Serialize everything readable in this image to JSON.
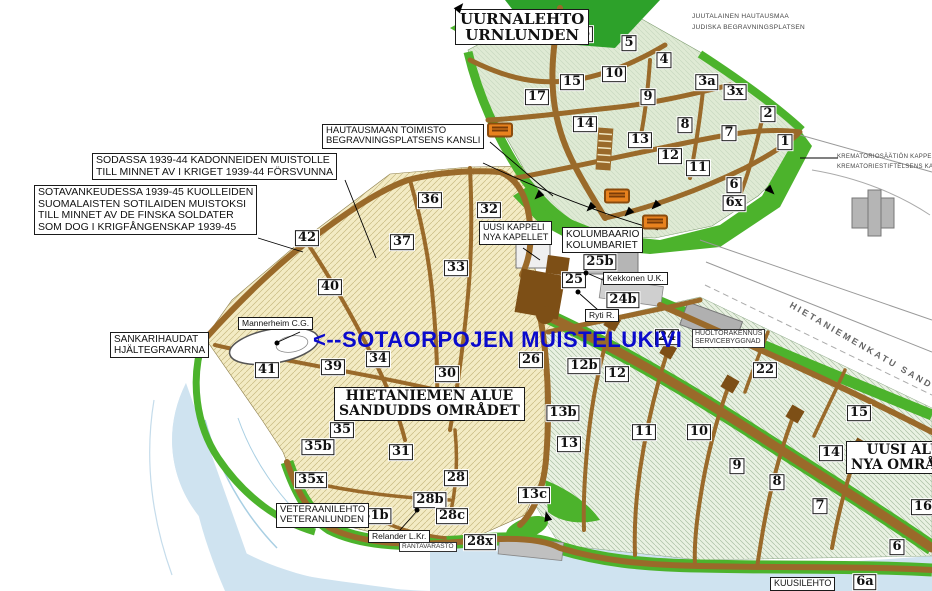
{
  "map": {
    "colors": {
      "water": "#cfe3f0",
      "old_area": "#f3ebc4",
      "new_area": "#e9f1e2",
      "urn_area": "#dfead4",
      "green": "#4cb32c",
      "dark_green": "#2da12a",
      "road": "#9a6a2a",
      "road_dark": "#7d4f16",
      "building": "#b5b5b5",
      "blue_text": "#0a0acc",
      "bus_orange": "#e8821e"
    },
    "labels": [
      {
        "id": "uurnalehto",
        "type": "serif-box",
        "x": 455,
        "y": 9,
        "size": 15,
        "lines": [
          "UURNALEHTO",
          "URNLUNDEN"
        ]
      },
      {
        "id": "juutalainen-hautausmaa",
        "type": "tiny",
        "x": 692,
        "y": 11,
        "size": 6.5,
        "lines": [
          "JUUTALAINEN HAUTAUSMAA",
          "JUDISKA BEGRAVNINGSPLATSEN"
        ]
      },
      {
        "id": "krematorio",
        "type": "tiny",
        "x": 837,
        "y": 152,
        "size": 6,
        "lines": [
          "KREMATORIOSÄÄTIÖN KAPPELI",
          "KREMATORIESTIFTELSENS KAPELL"
        ]
      },
      {
        "id": "hautausmaan-toimisto",
        "type": "box",
        "x": 322,
        "y": 124,
        "size": 9.5,
        "lines": [
          "HAUTAUSMAAN TOIMISTO",
          "BEGRAVNINGSPLATSENS KANSLI"
        ]
      },
      {
        "id": "sodassa-muistolle",
        "type": "box",
        "x": 92,
        "y": 153,
        "size": 10.5,
        "lines": [
          "SODASSA 1939-44 KADONNEIDEN MUISTOLLE",
          "TILL MINNET AV I KRIGET 1939-44 FÖRSVUNNA"
        ]
      },
      {
        "id": "sotavankeudessa",
        "type": "box",
        "x": 34,
        "y": 185,
        "size": 10.5,
        "lines": [
          "SOTAVANKEUDESSA 1939-45 KUOLLEIDEN",
          "SUOMALAISTEN SOTILAIDEN MUISTOKSI",
          "TILL MINNET AV DE FINSKA SOLDATER",
          "SOM DOG I KRIGFÅNGENSKAP 1939-45"
        ]
      },
      {
        "id": "uusi-kappeli",
        "type": "box",
        "x": 479,
        "y": 221,
        "size": 9,
        "lines": [
          "UUSI KAPPELI",
          "NYA KAPELLET"
        ]
      },
      {
        "id": "kolumbaario",
        "type": "box",
        "x": 562,
        "y": 227,
        "size": 10,
        "lines": [
          "KOLUMBAARIO",
          "KOLUMBARIET"
        ]
      },
      {
        "id": "sankarihaudat",
        "type": "box",
        "x": 110,
        "y": 332,
        "size": 10,
        "lines": [
          "SANKARIHAUDAT",
          "HJÄLTEGRAVARNA"
        ]
      },
      {
        "id": "mannerheim",
        "type": "box",
        "x": 238,
        "y": 317,
        "size": 8.5,
        "lines": [
          "Mannerheim C.G."
        ]
      },
      {
        "id": "kekkonen",
        "type": "box",
        "x": 603,
        "y": 272,
        "size": 8.5,
        "lines": [
          "Kekkonen U.K."
        ]
      },
      {
        "id": "ryti",
        "type": "box",
        "x": 585,
        "y": 309,
        "size": 8.5,
        "lines": [
          "Ryti R."
        ]
      },
      {
        "id": "hietaniemen-alue",
        "type": "serif-box",
        "x": 334,
        "y": 387,
        "size": 14,
        "lines": [
          "HIETANIEMEN ALUE",
          "SANDUDDS OMRÅDET"
        ]
      },
      {
        "id": "huoltorakennus",
        "type": "tiny-box",
        "x": 692,
        "y": 329,
        "size": 7,
        "lines": [
          "HUOLTORAKENNUS",
          "SERVICEBYGGNAD"
        ]
      },
      {
        "id": "veteraanilehto",
        "type": "box",
        "x": 276,
        "y": 503,
        "size": 9.5,
        "lines": [
          "VETERAANILEHTO",
          "VETERANLUNDEN"
        ]
      },
      {
        "id": "relander",
        "type": "box",
        "x": 368,
        "y": 530,
        "size": 8.5,
        "lines": [
          "Relander L.Kr."
        ]
      },
      {
        "id": "rantavarasto",
        "type": "tiny-box",
        "x": 399,
        "y": 542,
        "size": 6.5,
        "lines": [
          "RANTAVARASTO"
        ]
      },
      {
        "id": "uusi-alue",
        "type": "serif-box",
        "x": 846,
        "y": 441,
        "size": 13.5,
        "lines": [
          "UUSI ALUE",
          "NYA OMRÅDET"
        ]
      },
      {
        "id": "kuusilehto",
        "type": "box",
        "x": 770,
        "y": 577,
        "size": 9,
        "lines": [
          "KUUSILEHTO"
        ]
      },
      {
        "id": "hietaniemenkatu-street",
        "type": "street",
        "x": 793,
        "y": 300,
        "size": 9,
        "rotate": 30,
        "lines": [
          "HIETANIEMENKATU  SANDUDDSG"
        ]
      },
      {
        "id": "sotaorpojen-muistelukivi",
        "type": "blue",
        "x": 313,
        "y": 327,
        "size": 22,
        "lines": [
          "<--SOTAORPOJEN MUISTELUKIVI"
        ]
      }
    ],
    "plot_numbers": [
      {
        "label": "16",
        "x": 581,
        "y": 34
      },
      {
        "label": "5",
        "x": 629,
        "y": 43
      },
      {
        "label": "4",
        "x": 664,
        "y": 60
      },
      {
        "label": "10",
        "x": 614,
        "y": 74
      },
      {
        "label": "15",
        "x": 572,
        "y": 82
      },
      {
        "label": "3a",
        "x": 707,
        "y": 82
      },
      {
        "label": "3x",
        "x": 735,
        "y": 92
      },
      {
        "label": "17",
        "x": 537,
        "y": 97
      },
      {
        "label": "9",
        "x": 648,
        "y": 97
      },
      {
        "label": "2",
        "x": 768,
        "y": 114
      },
      {
        "label": "14",
        "x": 585,
        "y": 124
      },
      {
        "label": "8",
        "x": 685,
        "y": 125
      },
      {
        "label": "7",
        "x": 729,
        "y": 133
      },
      {
        "label": "13",
        "x": 640,
        "y": 140
      },
      {
        "label": "1",
        "x": 785,
        "y": 142
      },
      {
        "label": "12",
        "x": 670,
        "y": 156
      },
      {
        "label": "11",
        "x": 698,
        "y": 168
      },
      {
        "label": "6",
        "x": 734,
        "y": 185
      },
      {
        "label": "6x",
        "x": 734,
        "y": 203
      },
      {
        "label": "36",
        "x": 430,
        "y": 200
      },
      {
        "label": "32",
        "x": 489,
        "y": 210
      },
      {
        "label": "42",
        "x": 307,
        "y": 238
      },
      {
        "label": "37",
        "x": 402,
        "y": 242
      },
      {
        "label": "33",
        "x": 456,
        "y": 268
      },
      {
        "label": "40",
        "x": 330,
        "y": 287
      },
      {
        "label": "25b",
        "x": 600,
        "y": 262
      },
      {
        "label": "25",
        "x": 574,
        "y": 280
      },
      {
        "label": "24b",
        "x": 623,
        "y": 300
      },
      {
        "label": "41",
        "x": 267,
        "y": 370
      },
      {
        "label": "39",
        "x": 333,
        "y": 367
      },
      {
        "label": "34",
        "x": 378,
        "y": 359
      },
      {
        "label": "30",
        "x": 447,
        "y": 374
      },
      {
        "label": "26",
        "x": 531,
        "y": 360
      },
      {
        "label": "24",
        "x": 667,
        "y": 337
      },
      {
        "label": "12b",
        "x": 584,
        "y": 366
      },
      {
        "label": "12",
        "x": 617,
        "y": 374
      },
      {
        "label": "22",
        "x": 765,
        "y": 370
      },
      {
        "label": "27",
        "x": 495,
        "y": 401
      },
      {
        "label": "13b",
        "x": 563,
        "y": 413
      },
      {
        "label": "13",
        "x": 569,
        "y": 444
      },
      {
        "label": "11",
        "x": 644,
        "y": 432
      },
      {
        "label": "10",
        "x": 699,
        "y": 432
      },
      {
        "label": "15",
        "x": 859,
        "y": 413
      },
      {
        "label": "9",
        "x": 737,
        "y": 466
      },
      {
        "label": "14",
        "x": 831,
        "y": 453
      },
      {
        "label": "8",
        "x": 777,
        "y": 482
      },
      {
        "label": "7",
        "x": 820,
        "y": 506
      },
      {
        "label": "16",
        "x": 923,
        "y": 507
      },
      {
        "label": "6",
        "x": 897,
        "y": 547
      },
      {
        "label": "6a",
        "x": 865,
        "y": 582
      },
      {
        "label": "13c",
        "x": 534,
        "y": 495
      },
      {
        "label": "35",
        "x": 342,
        "y": 430
      },
      {
        "label": "35b",
        "x": 318,
        "y": 447
      },
      {
        "label": "35x",
        "x": 311,
        "y": 480
      },
      {
        "label": "31",
        "x": 401,
        "y": 452
      },
      {
        "label": "28",
        "x": 456,
        "y": 478
      },
      {
        "label": "28b",
        "x": 430,
        "y": 500
      },
      {
        "label": "31b",
        "x": 375,
        "y": 516
      },
      {
        "label": "28c",
        "x": 452,
        "y": 516
      },
      {
        "label": "28x",
        "x": 480,
        "y": 542
      }
    ],
    "bus_stops": [
      {
        "x": 500,
        "y": 130
      },
      {
        "x": 617,
        "y": 196
      },
      {
        "x": 655,
        "y": 222
      }
    ],
    "grave_dots": [
      {
        "x": 277,
        "y": 343
      },
      {
        "x": 586,
        "y": 273
      },
      {
        "x": 578,
        "y": 292
      },
      {
        "x": 417,
        "y": 510
      }
    ],
    "arrows": [
      {
        "x": 538,
        "y": 196,
        "r": 225
      },
      {
        "x": 590,
        "y": 208,
        "r": 225
      },
      {
        "x": 628,
        "y": 213,
        "r": 225
      },
      {
        "x": 655,
        "y": 206,
        "r": 225
      },
      {
        "x": 771,
        "y": 191,
        "r": 135
      },
      {
        "x": 547,
        "y": 516,
        "r": -15
      },
      {
        "x": 460,
        "y": 7,
        "r": 40
      }
    ]
  }
}
